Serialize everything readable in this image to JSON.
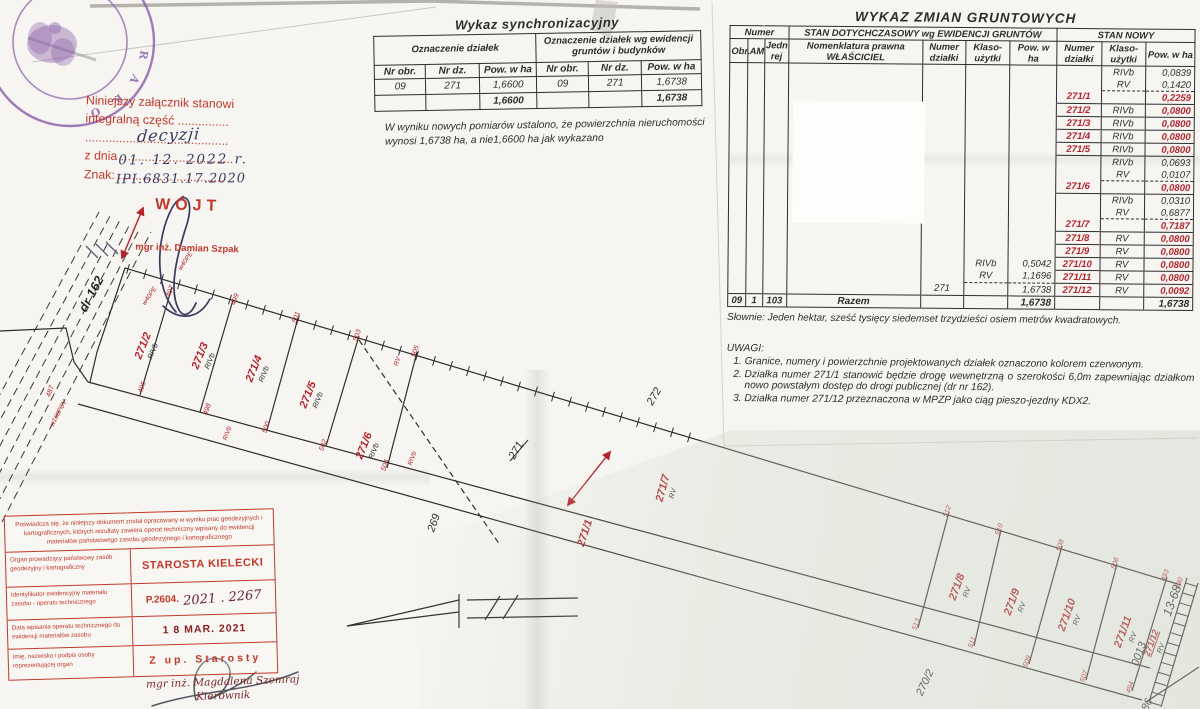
{
  "colors": {
    "paper": "#f6f5f1",
    "ink": "#2f2d2a",
    "red_print": "#c0392b",
    "red_map": "#b3242c",
    "purple_seal": "#8a5ca8",
    "handwriting": "#3b3a60"
  },
  "attachment_note": {
    "line1": "Niniejszy załącznik stanowi",
    "line2": "integralną część ...............",
    "line3": "..........................................",
    "line4_prefix": "z dnia",
    "line4_dots": ".................................",
    "line5_prefix": "Znak:",
    "line5_dots": "...............................",
    "hw_word": "decyzji",
    "hw_date": "01. 12. 2022 r.",
    "hw_znak": "IPI.6831.17.2020",
    "office": "WÓJT",
    "officer": "mgr inż. Damian Szpak"
  },
  "seal": {
    "letters": [
      "R",
      "A",
      "K",
      "O"
    ]
  },
  "sync_table": {
    "title": "Wykaz synchronizacyjny",
    "group1": "Oznaczenie działek",
    "group2": "Oznaczenie działek wg ewidencji gruntów i budynków",
    "columns": [
      "Nr obr.",
      "Nr dz.",
      "Pow. w ha",
      "Nr obr.",
      "Nr dz.",
      "Pow. w ha"
    ],
    "row": [
      "09",
      "271",
      "1,6600",
      "09",
      "271",
      "1,6738"
    ],
    "totals": [
      "",
      "",
      "1,6600",
      "",
      "",
      "1,6738"
    ],
    "note1": "W wyniku nowych pomiarów ustalono, że powierzchnia nieruchomości",
    "note2": "wynosi 1,6738 ha, a nie1,6600 ha jak wykazano"
  },
  "changes_table": {
    "title": "WYKAZ ZMIAN GRUNTOWYCH",
    "group_numer": "Numer",
    "group_old": "STAN DOTYCHCZASOWY wg EWIDENCJI GRUNTÓW",
    "group_new": "STAN NOWY",
    "columns": [
      "Obr.",
      "AM",
      "Jedn rej",
      "Nomenklatura prawna WŁAŚCICIEL",
      "Numer działki",
      "Klaso-użytki",
      "Pow. w ha",
      "Numer działki",
      "Klaso-użytki",
      "Pow. w ha"
    ],
    "rows": [
      [
        [
          "",
          ""
        ],
        [
          "",
          ""
        ],
        [
          "",
          ""
        ],
        [
          "",
          ""
        ],
        [
          "",
          ""
        ],
        [
          "",
          ""
        ],
        [
          "",
          ""
        ],
        [
          "",
          ""
        ],
        [
          "RIVb",
          ""
        ],
        [
          "0,0839",
          ""
        ]
      ],
      [
        [
          "",
          ""
        ],
        [
          "",
          ""
        ],
        [
          "",
          ""
        ],
        [
          "",
          ""
        ],
        [
          "",
          ""
        ],
        [
          "",
          ""
        ],
        [
          "",
          ""
        ],
        [
          "",
          ""
        ],
        [
          "RV",
          ""
        ],
        [
          "0,1420",
          ""
        ]
      ],
      [
        [
          "",
          ""
        ],
        [
          "",
          ""
        ],
        [
          "",
          ""
        ],
        [
          "",
          ""
        ],
        [
          "",
          ""
        ],
        [
          "",
          ""
        ],
        [
          "",
          ""
        ],
        [
          "271/1",
          "red"
        ],
        [
          "",
          "dash"
        ],
        [
          "0,2259",
          "red dash"
        ]
      ],
      [
        [
          "",
          ""
        ],
        [
          "",
          ""
        ],
        [
          "",
          ""
        ],
        [
          "",
          ""
        ],
        [
          "",
          ""
        ],
        [
          "",
          ""
        ],
        [
          "",
          ""
        ],
        [
          "271/2",
          "red bt"
        ],
        [
          "RIVb",
          "bt"
        ],
        [
          "0,0800",
          "red bt"
        ]
      ],
      [
        [
          "",
          ""
        ],
        [
          "",
          ""
        ],
        [
          "",
          ""
        ],
        [
          "",
          ""
        ],
        [
          "",
          ""
        ],
        [
          "",
          ""
        ],
        [
          "",
          ""
        ],
        [
          "271/3",
          "red bt"
        ],
        [
          "RIVb",
          "bt"
        ],
        [
          "0,0800",
          "red bt"
        ]
      ],
      [
        [
          "",
          ""
        ],
        [
          "",
          ""
        ],
        [
          "",
          ""
        ],
        [
          "",
          ""
        ],
        [
          "",
          ""
        ],
        [
          "",
          ""
        ],
        [
          "",
          ""
        ],
        [
          "271/4",
          "red bt"
        ],
        [
          "RIVb",
          "bt"
        ],
        [
          "0,0800",
          "red bt"
        ]
      ],
      [
        [
          "",
          ""
        ],
        [
          "",
          ""
        ],
        [
          "",
          ""
        ],
        [
          "",
          ""
        ],
        [
          "",
          ""
        ],
        [
          "",
          ""
        ],
        [
          "",
          ""
        ],
        [
          "271/5",
          "red bt"
        ],
        [
          "RIVb",
          "bt"
        ],
        [
          "0,0800",
          "red bt"
        ]
      ],
      [
        [
          "",
          ""
        ],
        [
          "",
          ""
        ],
        [
          "",
          ""
        ],
        [
          "",
          ""
        ],
        [
          "",
          ""
        ],
        [
          "",
          ""
        ],
        [
          "",
          ""
        ],
        [
          "",
          "bt"
        ],
        [
          "RIVb",
          "bt"
        ],
        [
          "0,0693",
          "bt"
        ]
      ],
      [
        [
          "",
          ""
        ],
        [
          "",
          ""
        ],
        [
          "",
          ""
        ],
        [
          "",
          ""
        ],
        [
          "",
          ""
        ],
        [
          "",
          ""
        ],
        [
          "",
          ""
        ],
        [
          "",
          ""
        ],
        [
          "RV",
          ""
        ],
        [
          "0,0107",
          ""
        ]
      ],
      [
        [
          "",
          ""
        ],
        [
          "",
          ""
        ],
        [
          "",
          ""
        ],
        [
          "",
          ""
        ],
        [
          "",
          ""
        ],
        [
          "",
          ""
        ],
        [
          "",
          ""
        ],
        [
          "271/6",
          "red"
        ],
        [
          "",
          "dash"
        ],
        [
          "0,0800",
          "red dash"
        ]
      ],
      [
        [
          "",
          ""
        ],
        [
          "",
          ""
        ],
        [
          "",
          ""
        ],
        [
          "",
          ""
        ],
        [
          "",
          ""
        ],
        [
          "",
          ""
        ],
        [
          "",
          ""
        ],
        [
          "",
          "bt"
        ],
        [
          "RIVb",
          "bt"
        ],
        [
          "0,0310",
          "bt"
        ]
      ],
      [
        [
          "",
          ""
        ],
        [
          "",
          ""
        ],
        [
          "",
          ""
        ],
        [
          "",
          ""
        ],
        [
          "",
          ""
        ],
        [
          "",
          ""
        ],
        [
          "",
          ""
        ],
        [
          "",
          ""
        ],
        [
          "RV",
          ""
        ],
        [
          "0,6877",
          ""
        ]
      ],
      [
        [
          "",
          ""
        ],
        [
          "",
          ""
        ],
        [
          "",
          ""
        ],
        [
          "",
          ""
        ],
        [
          "",
          ""
        ],
        [
          "",
          ""
        ],
        [
          "",
          ""
        ],
        [
          "271/7",
          "red"
        ],
        [
          "",
          "dash"
        ],
        [
          "0,7187",
          "red dash"
        ]
      ],
      [
        [
          "",
          ""
        ],
        [
          "",
          ""
        ],
        [
          "",
          ""
        ],
        [
          "",
          ""
        ],
        [
          "",
          ""
        ],
        [
          "",
          ""
        ],
        [
          "",
          ""
        ],
        [
          "271/8",
          "red bt"
        ],
        [
          "RV",
          "bt"
        ],
        [
          "0,0800",
          "red bt"
        ]
      ],
      [
        [
          "",
          ""
        ],
        [
          "",
          ""
        ],
        [
          "",
          ""
        ],
        [
          "",
          ""
        ],
        [
          "",
          ""
        ],
        [
          "",
          ""
        ],
        [
          "",
          ""
        ],
        [
          "271/9",
          "red bt"
        ],
        [
          "RV",
          "bt"
        ],
        [
          "0,0800",
          "red bt"
        ]
      ],
      [
        [
          "",
          ""
        ],
        [
          "",
          ""
        ],
        [
          "",
          ""
        ],
        [
          "",
          ""
        ],
        [
          "",
          ""
        ],
        [
          "RIVb",
          ""
        ],
        [
          "0,5042",
          ""
        ],
        [
          "271/10",
          "red bt"
        ],
        [
          "RV",
          "bt"
        ],
        [
          "0,0800",
          "red bt"
        ]
      ],
      [
        [
          "",
          ""
        ],
        [
          "",
          ""
        ],
        [
          "",
          ""
        ],
        [
          "",
          ""
        ],
        [
          "",
          ""
        ],
        [
          "RV",
          ""
        ],
        [
          "1,1696",
          ""
        ],
        [
          "271/11",
          "red bt"
        ],
        [
          "RV",
          "bt"
        ],
        [
          "0,0800",
          "red bt"
        ]
      ],
      [
        [
          "",
          ""
        ],
        [
          "",
          ""
        ],
        [
          "",
          ""
        ],
        [
          "",
          ""
        ],
        [
          "271",
          ""
        ],
        [
          "",
          "dash"
        ],
        [
          "1,6738",
          "dash"
        ],
        [
          "271/12",
          "red bt"
        ],
        [
          "RV",
          "bt"
        ],
        [
          "0,0092",
          "red bt"
        ]
      ]
    ],
    "footer": [
      [
        "09",
        ""
      ],
      [
        "1",
        ""
      ],
      [
        "103",
        ""
      ],
      [
        "Razem",
        "bold"
      ],
      [
        "",
        ""
      ],
      [
        "",
        ""
      ],
      [
        "1,6738",
        "bold"
      ],
      [
        "",
        ""
      ],
      [
        "",
        ""
      ],
      [
        "1,6738",
        "bold"
      ]
    ],
    "slownie": "Słownie: Jeden hektar, sześć tysięcy siedemset trzydzieści osiem metrów kwadratowych.",
    "uwagi_title": "UWAGI:",
    "uwagi": [
      "Granice, numery i powierzchnie projektowanych działek oznaczono kolorem czerwonym.",
      "Działka numer 271/1 stanowić będzie drogę wewnętrzną o szerokości 6,0m zapewniając działkom nowo powstałym dostęp do drogi publicznej (dr nr 162).",
      "Działka numer 271/12 przeznaczona w MPZP jako ciąg pieszo-jezdny KDX2."
    ]
  },
  "cert_stamp": {
    "header": "Poświadcza się, że niniejszy dokument został opracowany w wyniku prac geodezyjnych i kartograficznych, których rezultaty zawiera operat techniczny wpisany do ewidencji materiałów państwowego zasobu geodezyjnego i kartograficznego",
    "rows": [
      {
        "label": "Organ prowadzący państwowy zasób geodezyjny i kartograficzny",
        "value": "STAROSTA KIELECKI"
      },
      {
        "label": "Identyfikator ewidencyjny materiału zasobu - operatu technicznego",
        "value": "P.2604.",
        "handwritten": "2021 . 2267"
      },
      {
        "label": "Data wpisania operatu technicznego do ewidencji materiałów zasobu",
        "value": "1 8 MAR. 2021"
      },
      {
        "label": "Imię, nazwisko i podpis osoby reprezentującej organ",
        "value": "Z up. Starosty"
      }
    ],
    "signature_name": "mgr inż. Magdalena Szemraj",
    "signature_role": "Kierownik"
  },
  "map": {
    "road_label": {
      "t": "dr 162",
      "x": 95,
      "y": 296,
      "r": -62
    },
    "parcels": [
      {
        "t": "271/2",
        "sub": "RIVb",
        "x": 146,
        "y": 347,
        "r": -68
      },
      {
        "t": "271/3",
        "sub": "RIVb",
        "x": 203,
        "y": 357,
        "r": -68
      },
      {
        "t": "271/4",
        "sub": "RIVb",
        "x": 257,
        "y": 370,
        "r": -68
      },
      {
        "t": "271/5",
        "sub": "RIVb",
        "x": 311,
        "y": 396,
        "r": -68
      },
      {
        "t": "271/6",
        "sub": "RIVb",
        "x": 367,
        "y": 447,
        "r": -68
      },
      {
        "t": "271/1",
        "sub": "",
        "x": 588,
        "y": 534,
        "r": -72
      },
      {
        "t": "271/7",
        "sub": "RV",
        "x": 666,
        "y": 489,
        "r": -75
      },
      {
        "t": "271/8",
        "sub": "RV",
        "x": 960,
        "y": 588,
        "r": -70
      },
      {
        "t": "271/9",
        "sub": "RV",
        "x": 1015,
        "y": 603,
        "r": -70
      },
      {
        "t": "271/10",
        "sub": "RV",
        "x": 1070,
        "y": 616,
        "r": -70
      },
      {
        "t": "271/11",
        "sub": "RV",
        "x": 1126,
        "y": 633,
        "r": -70
      },
      {
        "t": "271/12",
        "sub": "RV",
        "x": 1154,
        "y": 644,
        "r": -70,
        "u": 1,
        "small": 1
      }
    ],
    "points": [
      [
        "487",
        52,
        392
      ],
      [
        "495",
        144,
        388
      ],
      [
        "497",
        172,
        292
      ],
      [
        "499",
        237,
        300
      ],
      [
        "501",
        298,
        318
      ],
      [
        "503",
        359,
        336
      ],
      [
        "505",
        417,
        352
      ],
      [
        "498",
        209,
        410
      ],
      [
        "500",
        268,
        428
      ],
      [
        "502",
        325,
        446
      ],
      [
        "504",
        387,
        466
      ],
      [
        "512",
        949,
        512
      ],
      [
        "510",
        1001,
        530
      ],
      [
        "508",
        1062,
        546
      ],
      [
        "506",
        1117,
        564
      ],
      [
        "493",
        1167,
        576
      ],
      [
        "490",
        1181,
        584
      ],
      [
        "513",
        918,
        625
      ],
      [
        "511",
        974,
        643
      ],
      [
        "509",
        1029,
        662
      ],
      [
        "507",
        1086,
        677
      ],
      [
        "494",
        1132,
        688
      ]
    ],
    "neighbors": [
      {
        "t": "269",
        "x": 437,
        "y": 524,
        "r": -70
      },
      {
        "t": "270/2",
        "x": 928,
        "y": 684,
        "r": -65
      },
      {
        "t": "272",
        "x": 657,
        "y": 398,
        "r": -60
      },
      {
        "t": "271",
        "x": 519,
        "y": 452,
        "r": -60,
        "strike": 1
      },
      {
        "t": "0013",
        "x": 1142,
        "y": 655,
        "r": -70
      },
      {
        "t": "13-68",
        "x": 1176,
        "y": 602,
        "r": -70,
        "big": 1
      },
      {
        "t": "86",
        "x": 1150,
        "y": 706,
        "r": -65
      }
    ],
    "annotations": [
      {
        "t": "w40PE",
        "x": 187,
        "y": 262,
        "r": -55
      },
      {
        "t": "w40PE",
        "x": 151,
        "y": 297,
        "r": -55
      },
      {
        "t": "w160PCV",
        "x": 60,
        "y": 414,
        "r": -62
      },
      {
        "t": "RIVb",
        "x": 229,
        "y": 434,
        "r": -70
      },
      {
        "t": "RV",
        "x": 399,
        "y": 362,
        "r": -70
      },
      {
        "t": "RIVb",
        "x": 414,
        "y": 459,
        "r": -70
      }
    ]
  }
}
